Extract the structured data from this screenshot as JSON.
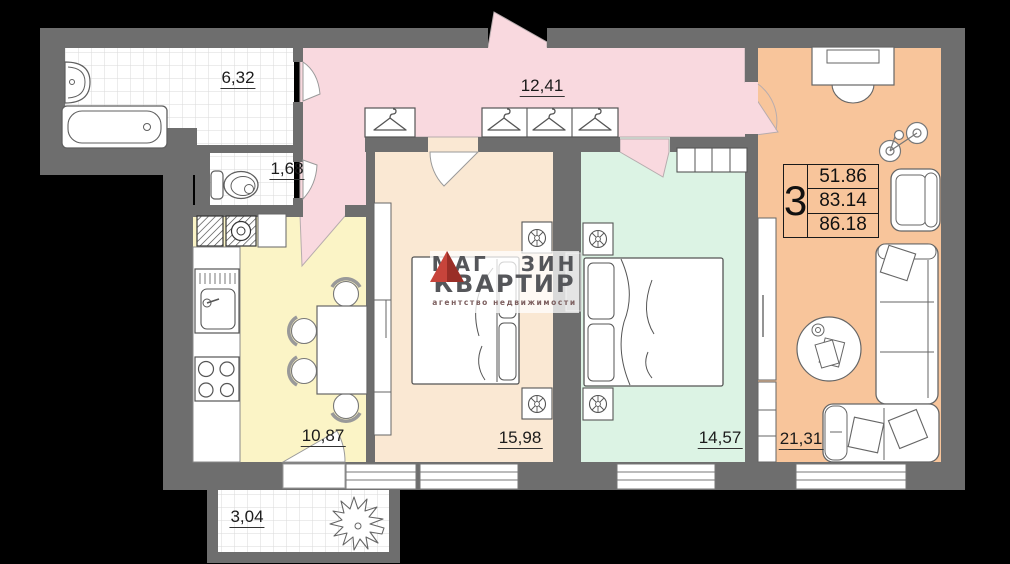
{
  "areas": {
    "bathroom": "6,32",
    "toilet": "1,68",
    "hallway": "12,41",
    "kitchen": "10,87",
    "bedroom_1": "15,98",
    "bedroom_2": "14,57",
    "living_room": "21,31",
    "balcony": "3,04"
  },
  "info_table": {
    "rooms": "3",
    "rows": [
      "51.86",
      "83.14",
      "86.18"
    ]
  },
  "watermark": {
    "brand_top_left": "МАГ",
    "brand_top_right": "ЗИН",
    "brand_bottom": "КВАРТИР",
    "tagline": "агентство недвижимости"
  },
  "colors": {
    "background": "#000000",
    "wall": "#6e6e6e",
    "hallway": "#f9d9df",
    "kitchen": "#fbf4c6",
    "bedroom1": "#fae8d3",
    "bedroom2": "#dcf3e4",
    "living": "#f8c59b",
    "tile_line": "#dadada",
    "label": "#1b1b1b",
    "watermark_text": "#55565a",
    "logo_red": "#c7443b",
    "logo_red_dark": "#992e27",
    "logo_sub": "#7d6060"
  }
}
